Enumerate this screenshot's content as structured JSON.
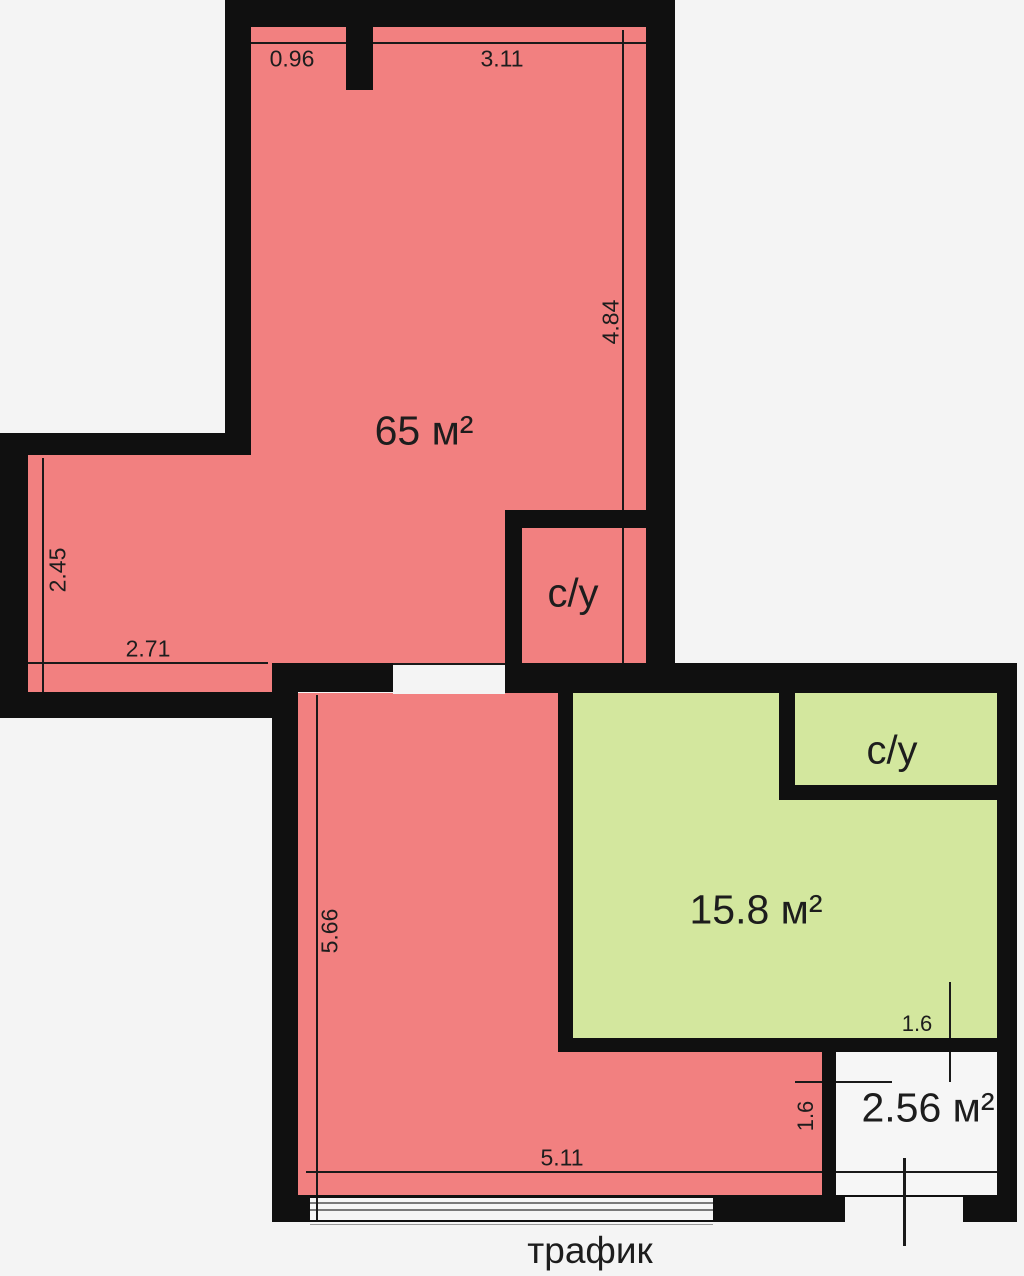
{
  "rooms": {
    "main": {
      "area_label": "65 м²"
    },
    "bathroom_top": {
      "label": "с/у"
    },
    "bathroom_right": {
      "label": "с/у"
    },
    "living": {
      "area_label": "15.8 м²"
    },
    "hall": {
      "area_label": "2.56 м²"
    }
  },
  "dimensions": {
    "top_left": "0.96",
    "top_right": "3.11",
    "main_right_height": "4.84",
    "main_left_height": "2.45",
    "main_bottom_width": "2.71",
    "lower_left_height": "5.66",
    "lower_bottom_width": "5.11",
    "hall_width": "1.6",
    "hall_height": "1.6"
  },
  "annotations": {
    "traffic": "трафик"
  },
  "colors": {
    "room_red": "#f28080",
    "room_green": "#d3e79e",
    "wall_black": "#101010",
    "background": "#f4f4f4",
    "glass_white": "#f6f6f6",
    "window_line": "#7a7a7a",
    "dimension_line": "#1a1a1a",
    "text": "#1d1d1d"
  }
}
